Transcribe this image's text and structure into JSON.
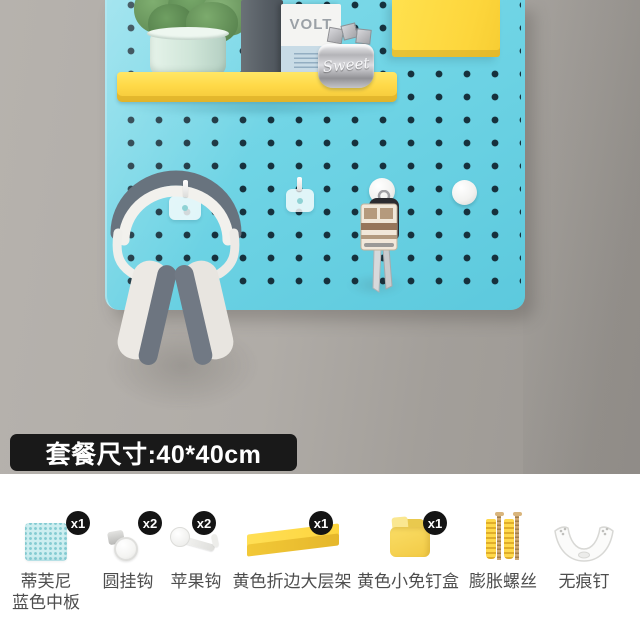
{
  "banner": {
    "text": "套餐尺寸:40*40cm"
  },
  "photo": {
    "book_title": "VOLT",
    "jar_text": "Sweet"
  },
  "colors": {
    "pegboard_blue": "#6fd4e5",
    "hole_dark": "#16313d",
    "shelf_yellow": "#ffd948",
    "box_yellow": "#fdd63c",
    "wall_gray": "#aba7a2",
    "banner_bg": "#191919",
    "label_gray": "#4d4d4d"
  },
  "items": [
    {
      "label": "蒂芙尼",
      "label2": "蓝色中板",
      "count": "x1"
    },
    {
      "label": "圆挂钩",
      "count": "x2"
    },
    {
      "label": "苹果钩",
      "count": "x2"
    },
    {
      "label": "黄色折边大层架",
      "count": "x1"
    },
    {
      "label": "黄色小免钉盒",
      "count": "x1"
    },
    {
      "label": "膨胀螺丝",
      "count": ""
    },
    {
      "label": "无痕钉",
      "count": ""
    }
  ]
}
